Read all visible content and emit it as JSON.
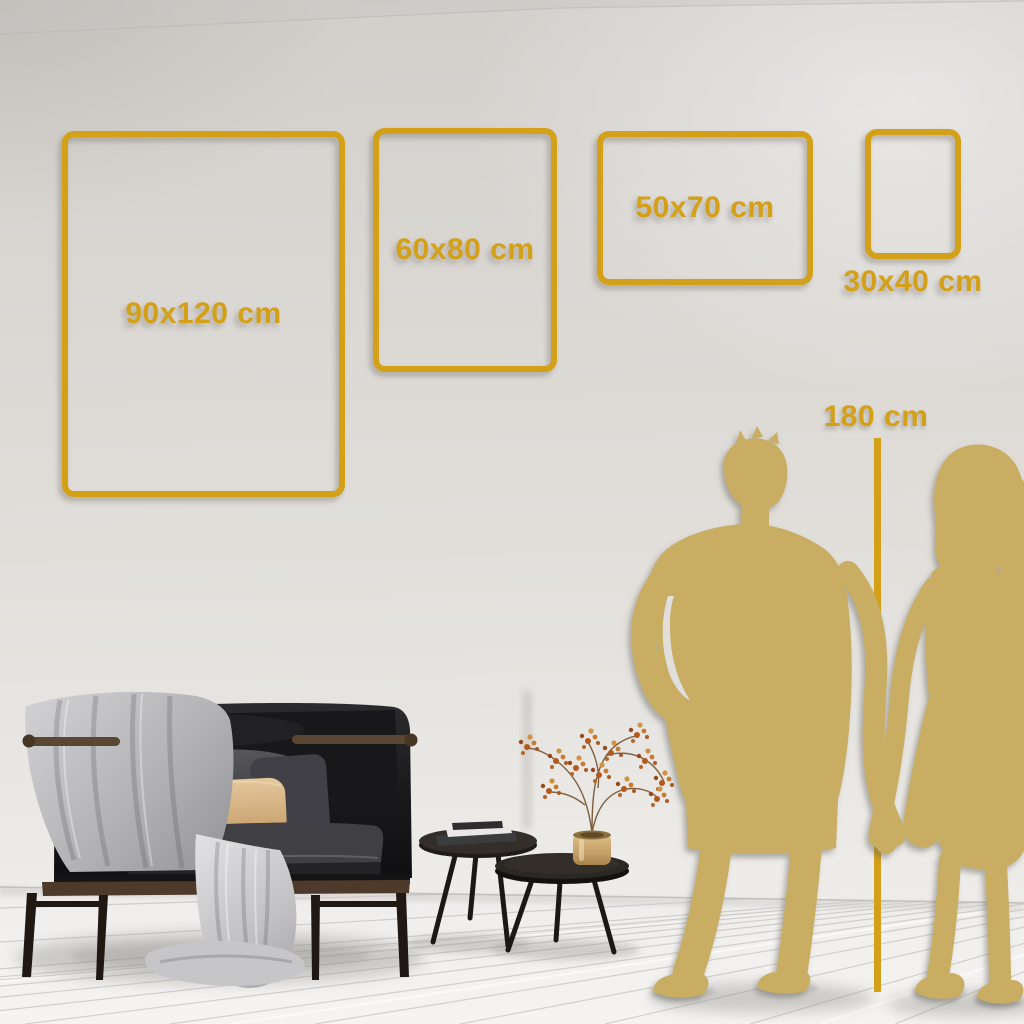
{
  "title": "Wall art size guide room visualization",
  "colors": {
    "accent_gold": "#D4A017",
    "silhouette_gold": "#C8AD62",
    "wall": "#DCD9D5",
    "floor": "#F3F2F0"
  },
  "frames": [
    {
      "id": "90x120",
      "label": "90x120 cm"
    },
    {
      "id": "60x80",
      "label": "60x80 cm"
    },
    {
      "id": "50x70",
      "label": "50x70 cm"
    },
    {
      "id": "30x40",
      "label": "30x40 cm"
    }
  ],
  "height_marker": {
    "label": "180 cm"
  },
  "scene_objects": [
    "dark loveseat sofa with gray throw blanket and pillows",
    "nested round coffee tables with books",
    "gold vase with dried flower branch",
    "gold couple silhouette holding hands"
  ]
}
